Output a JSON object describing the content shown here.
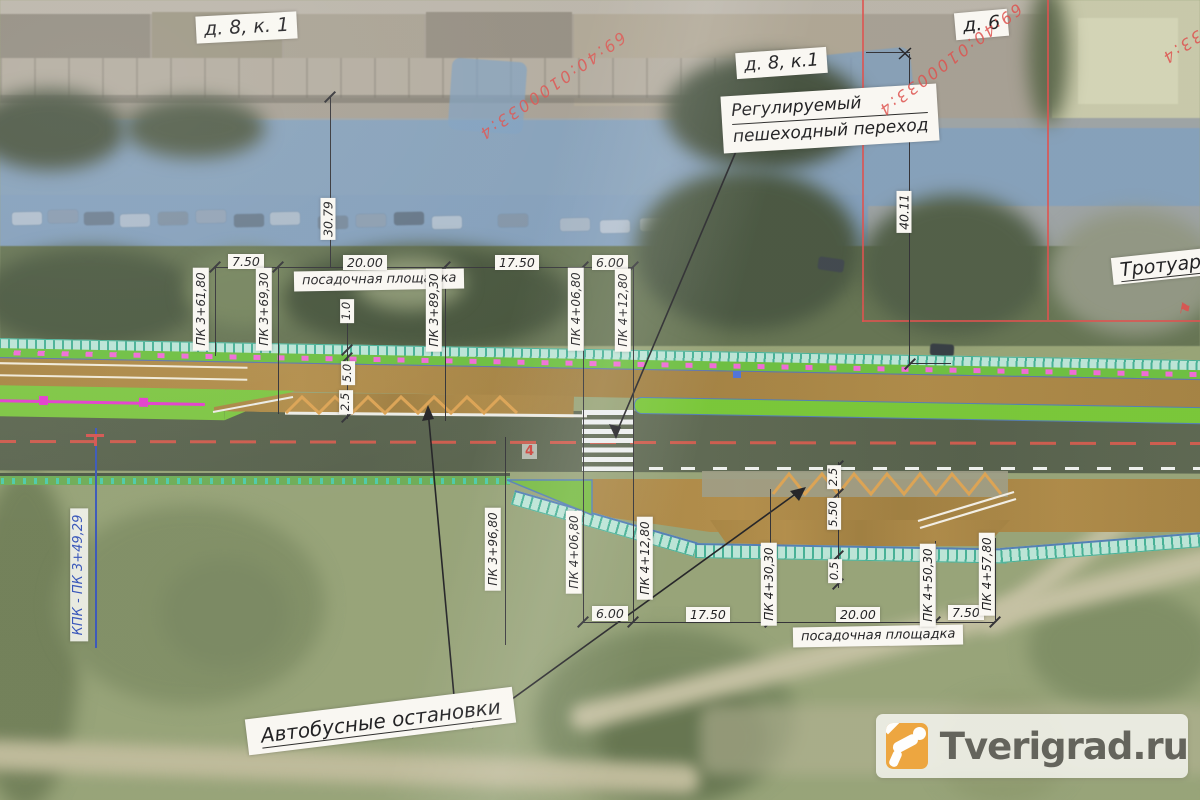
{
  "plan": {
    "houses": [
      "д. 8, к. 1",
      "д. 8, к.1",
      "д. 6"
    ],
    "notes": {
      "crossing1": "Регулируемый",
      "crossing2": "пешеходный переход",
      "sidewalk": "Тротуар",
      "busstops": "Автобусные остановки",
      "landing": "посадочная площадка",
      "kpk": "КПК - ПК 3+49,29",
      "marker4": "4"
    },
    "cadastral": "69:40:0100033:4",
    "dims": {
      "top": [
        "7.50",
        "20.00",
        "17.50",
        "6.00"
      ],
      "bottom": [
        "6.00",
        "17.50",
        "20.00",
        "7.50"
      ],
      "v_top": [
        "30.79",
        "40.11"
      ],
      "w_top": [
        "1.0",
        "5.0",
        "2.5"
      ],
      "w_bottom": [
        "2.5",
        "5.50",
        "0.5"
      ]
    },
    "stations": {
      "top": [
        "ПК 3+61,80",
        "ПК 3+69,30",
        "ПК 3+89,30",
        "ПК 4+06,80",
        "ПК 4+12,80"
      ],
      "bottom": [
        "ПК 3+96,80",
        "ПК 4+06,80",
        "ПК 4+12,80",
        "ПК 4+30,30",
        "ПК 4+50,30",
        "ПК 4+57,80"
      ]
    },
    "colors": {
      "cadastral_red": "#dd4b48",
      "design_brown": "#a8833f",
      "design_green": "#6fc23a",
      "fence_teal": "#3fae93",
      "marking_pink": "#ef66d6",
      "chain_magenta": "#e238cc",
      "zigzag_orange": "#dba04e",
      "centerline_red": "#e05548",
      "kpk_blue": "#3050b8",
      "watermark_orange": "#eda338"
    }
  },
  "watermark": {
    "text": "Tverigrad.ru"
  }
}
